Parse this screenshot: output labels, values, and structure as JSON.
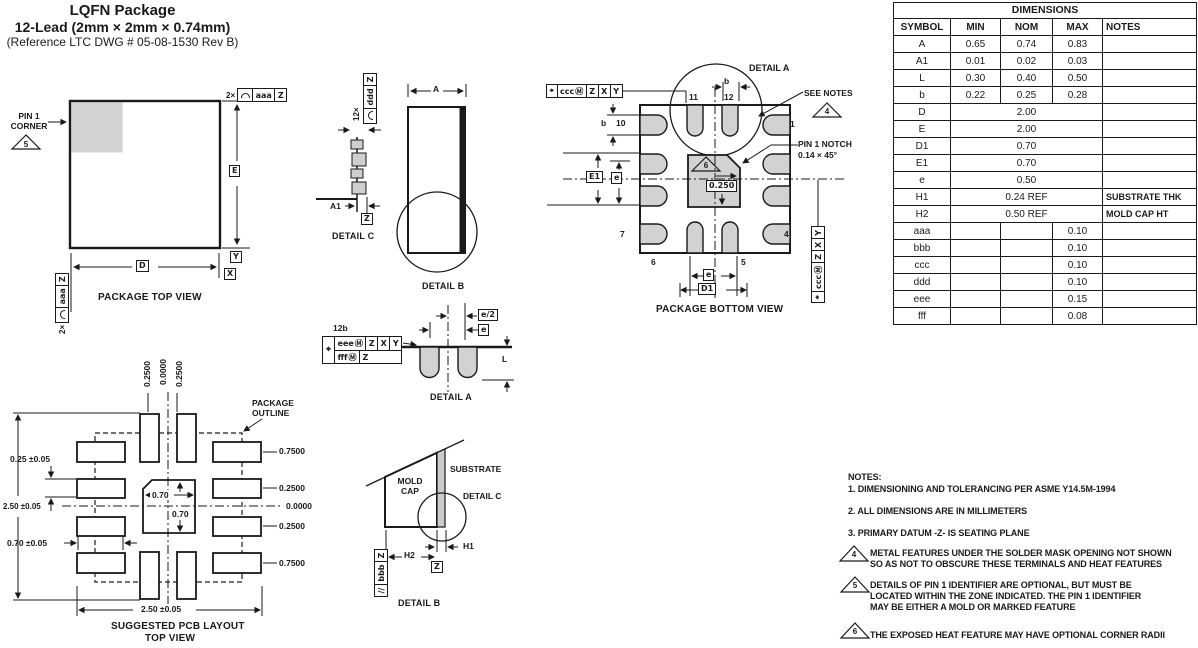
{
  "title": {
    "line1": "LQFN Package",
    "line2": "12-Lead (2mm × 2mm × 0.74mm)",
    "line3": "(Reference LTC DWG # 05-08-1530 Rev B)"
  },
  "dim_table": {
    "title": "DIMENSIONS",
    "headers": [
      "SYMBOL",
      "MIN",
      "NOM",
      "MAX",
      "NOTES"
    ],
    "rows": [
      {
        "symbol": "A",
        "min": "0.65",
        "nom": "0.74",
        "max": "0.83",
        "notes": ""
      },
      {
        "symbol": "A1",
        "min": "0.01",
        "nom": "0.02",
        "max": "0.03",
        "notes": ""
      },
      {
        "symbol": "L",
        "min": "0.30",
        "nom": "0.40",
        "max": "0.50",
        "notes": ""
      },
      {
        "symbol": "b",
        "min": "0.22",
        "nom": "0.25",
        "max": "0.28",
        "notes": ""
      },
      {
        "symbol": "D",
        "span": "2.00",
        "notes": ""
      },
      {
        "symbol": "E",
        "span": "2.00",
        "notes": ""
      },
      {
        "symbol": "D1",
        "span": "0.70",
        "notes": ""
      },
      {
        "symbol": "E1",
        "span": "0.70",
        "notes": ""
      },
      {
        "symbol": "e",
        "span": "0.50",
        "notes": ""
      },
      {
        "symbol": "H1",
        "span": "0.24 REF",
        "notes": "SUBSTRATE THK"
      },
      {
        "symbol": "H2",
        "span": "0.50 REF",
        "notes": "MOLD CAP HT"
      },
      {
        "symbol": "aaa",
        "min": "",
        "nom": "",
        "max": "0.10",
        "notes": ""
      },
      {
        "symbol": "bbb",
        "min": "",
        "nom": "",
        "max": "0.10",
        "notes": ""
      },
      {
        "symbol": "ccc",
        "min": "",
        "nom": "",
        "max": "0.10",
        "notes": ""
      },
      {
        "symbol": "ddd",
        "min": "",
        "nom": "",
        "max": "0.10",
        "notes": ""
      },
      {
        "symbol": "eee",
        "min": "",
        "nom": "",
        "max": "0.15",
        "notes": ""
      },
      {
        "symbol": "fff",
        "min": "",
        "nom": "",
        "max": "0.08",
        "notes": ""
      }
    ]
  },
  "top_view": {
    "pin1_line1": "PIN 1",
    "pin1_line2": "CORNER",
    "note_ref": "5",
    "fcf_count": "2×",
    "fcf_tol": "aaa",
    "fcf_datum": "Z",
    "dim_e": "E",
    "dim_d": "D",
    "datum_x": "X",
    "datum_y": "Y",
    "caption": "PACKAGE TOP VIEW"
  },
  "detail_c": {
    "fcf_count": "12×",
    "fcf_tol": "ddd",
    "fcf_datum": "Z",
    "dim_a1": "A1",
    "datum_z": "Z",
    "caption": "DETAIL C"
  },
  "side_view": {
    "dim_a": "A",
    "caption": "DETAIL B"
  },
  "bottom_view": {
    "fcf_sym": "⌖",
    "fcf_tol": "ccc",
    "fcf_mod": "Ⓜ",
    "fcf_d1": "Z",
    "fcf_d2": "X",
    "fcf_d3": "Y",
    "detail_a_label": "DETAIL A",
    "dim_b_top": "b",
    "dim_b_left": "b",
    "pin_1": "1",
    "pin_4": "4",
    "pin_5": "5",
    "pin_6": "6",
    "pin_7": "7",
    "pin_10": "10",
    "pin_11": "11",
    "pin_12": "12",
    "see_notes": "SEE NOTES",
    "note_ref": "4",
    "notch_line1": "PIN 1 NOTCH",
    "notch_line2": "0.14 × 45°",
    "dim_e1": "E1",
    "dim_e_side": "e",
    "heat_note_ref": "6",
    "pad_offset": "0.250",
    "dim_e_bottom": "e",
    "dim_d1": "D1",
    "caption": "PACKAGE BOTTOM VIEW"
  },
  "detail_a": {
    "callout": "12b",
    "fcf_sym": "⌖",
    "r1_tol": "eee",
    "r1_mod": "Ⓜ",
    "r1_d1": "Z",
    "r1_d2": "X",
    "r1_d3": "Y",
    "r2_tol": "fff",
    "r2_mod": "Ⓜ",
    "r2_d1": "Z",
    "dim_e_half": "e/2",
    "dim_e": "e",
    "dim_l": "L",
    "caption": "DETAIL A"
  },
  "pcb": {
    "top_offsets": [
      "0.2500",
      "0.0000",
      "0.2500"
    ],
    "outline_line1": "PACKAGE",
    "outline_line2": "OUTLINE",
    "dim_pad_h": "0.25 ±0.05",
    "dim_span_v": "2.50 ±0.05",
    "dim_pad_w": "0.70 ±0.05",
    "center_w": "0.70",
    "center_h": "0.70",
    "right_offsets": [
      "0.7500",
      "0.2500",
      "0.0000",
      "0.2500",
      "0.7500"
    ],
    "dim_span_h": "2.50 ±0.05",
    "caption_line1": "SUGGESTED PCB LAYOUT",
    "caption_line2": "TOP VIEW"
  },
  "detail_b": {
    "mold_line1": "MOLD",
    "mold_line2": "CAP",
    "substrate": "SUBSTRATE",
    "detail_c_ref": "DETAIL C",
    "dim_h1": "H1",
    "dim_h2": "H2",
    "fcf_sym": "//",
    "fcf_tol": "bbb",
    "fcf_datum": "Z",
    "datum_z": "Z",
    "caption": "DETAIL B"
  },
  "notes": {
    "heading": "NOTES:",
    "items": [
      "1. DIMENSIONING AND TOLERANCING PER ASME Y14.5M-1994",
      "2. ALL DIMENSIONS ARE IN MILLIMETERS",
      "3. PRIMARY DATUM -Z- IS SEATING PLANE"
    ],
    "flagged": [
      {
        "ref": "4",
        "lines": [
          "METAL FEATURES UNDER THE SOLDER MASK OPENING NOT SHOWN",
          "SO AS NOT TO  OBSCURE THESE TERMINALS AND HEAT FEATURES"
        ]
      },
      {
        "ref": "5",
        "lines": [
          "DETAILS OF PIN 1 IDENTIFIER ARE OPTIONAL, BUT MUST BE",
          "LOCATED WITHIN THE ZONE INDICATED. THE PIN 1 IDENTIFIER",
          "MAY BE EITHER A MOLD OR MARKED FEATURE"
        ]
      },
      {
        "ref": "6",
        "lines": [
          "THE EXPOSED HEAT FEATURE MAY HAVE OPTIONAL CORNER RADII"
        ]
      }
    ]
  },
  "colors": {
    "line": "#1a1a1a",
    "pad_fill": "#d2d2d2",
    "substrate_fill": "#cccccc"
  }
}
